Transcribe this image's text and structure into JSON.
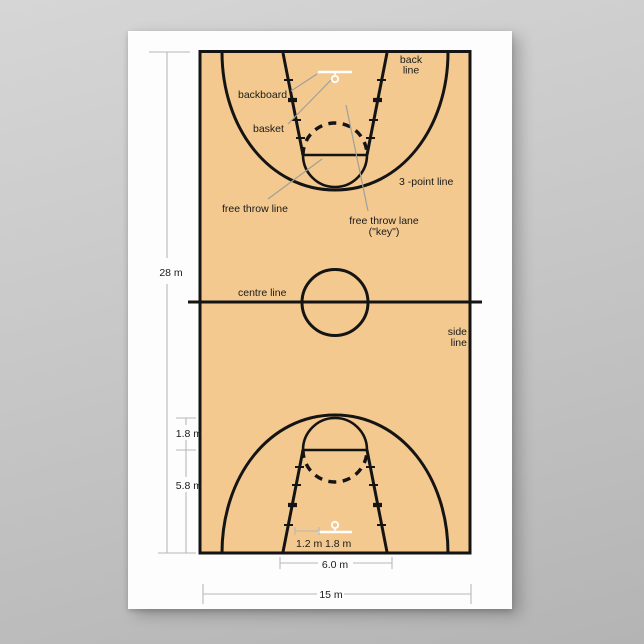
{
  "labels": {
    "back_line": [
      "back",
      "line"
    ],
    "backboard": "backboard",
    "basket": "basket",
    "three_point_line": "3 -point line",
    "free_throw_line": "free throw line",
    "free_throw_lane": [
      "free throw lane",
      "(\"key\")"
    ],
    "centre_line": "centre line",
    "side_line": [
      "side",
      "line"
    ]
  },
  "dimensions": {
    "court_length": "28 m",
    "free_throw_circle_radius": "1.8 m",
    "free_throw_line_distance": "5.8 m",
    "backboard_offset": "1.2 m",
    "backboard_width": "1.8 m",
    "lane_base_width": "6.0 m",
    "court_width": "15 m"
  },
  "colors": {
    "page_background": "#c9c9c9",
    "poster_background": "#fdfdfd",
    "court_fill": "#f3c98f",
    "court_line": "#141414",
    "backboard": "#ffffff",
    "dimension_line": "#b8b8b8",
    "leader_line": "#a0a098",
    "label_text": "#1a1a1a"
  }
}
